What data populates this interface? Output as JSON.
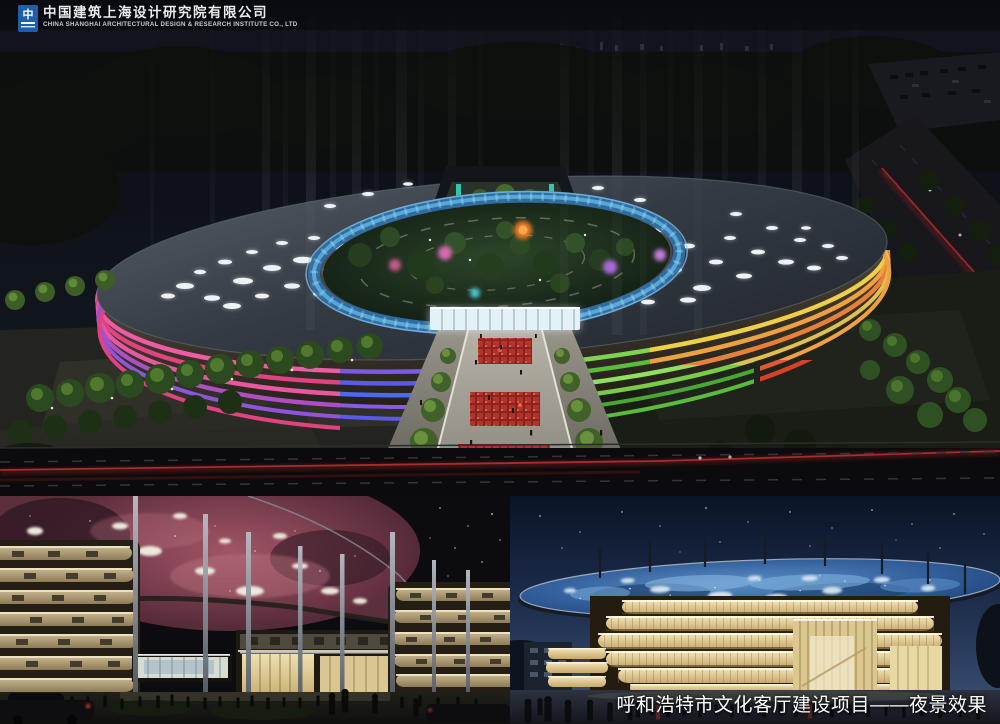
{
  "logo": {
    "icon": "cscec-square-logo-icon",
    "company_name_zh": "中国建筑上海设计研究院有限公司",
    "company_name_en": "CHINA SHANGHAI ARCHITECTURAL DESIGN & RESEARCH INSTITUTE CO., LTD"
  },
  "caption": {
    "text": "呼和浩特市文化客厅建设项目——夜景效果"
  },
  "panels": {
    "main": {
      "label": "aerial night view of elliptical cultural complex with light beams"
    },
    "bottom_left": {
      "label": "ground-level view with nebula-projection canopy"
    },
    "bottom_right": {
      "label": "ground-level dusk view with starry blue canopy"
    }
  },
  "palette": {
    "caption-color": "#ffffff",
    "logo-blue": "#1e5fa8",
    "accent-pink": "#e858a0",
    "accent-purple": "#6a5ae0",
    "accent-green": "#78cc48",
    "accent-orange": "#e8903a",
    "glass-cyan": "#4ab8e8",
    "canopy-nebula": "#8a4055",
    "canopy-blue": "#2e5a96",
    "band-gold": "#e5d3a0"
  }
}
